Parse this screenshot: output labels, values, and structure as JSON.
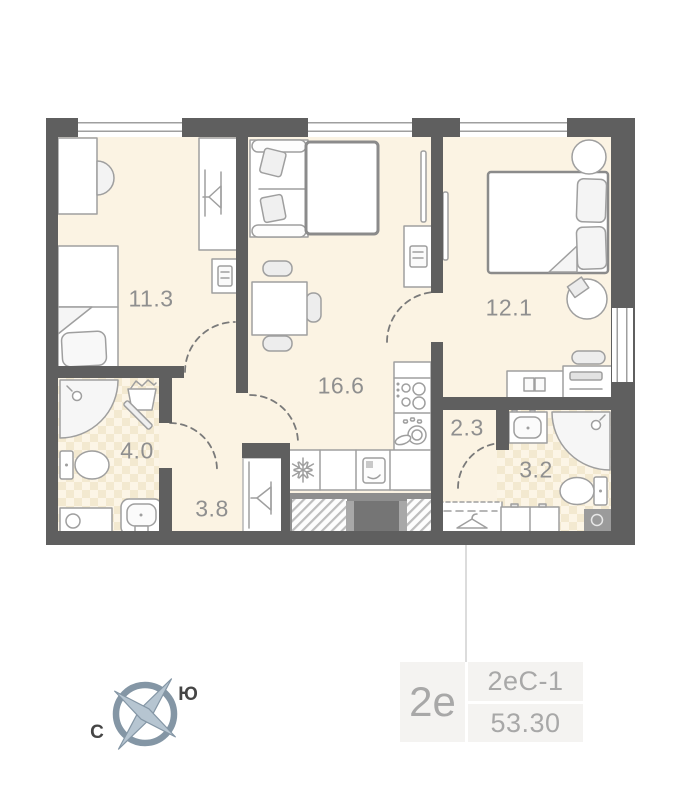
{
  "plan": {
    "rooms": [
      {
        "name": "bedroom-1",
        "area": "11.3"
      },
      {
        "name": "living-kitchen",
        "area": "16.6"
      },
      {
        "name": "bedroom-2",
        "area": "12.1"
      },
      {
        "name": "bathroom-1",
        "area": "4.0"
      },
      {
        "name": "hallway",
        "area": "3.8"
      },
      {
        "name": "corridor",
        "area": "2.3"
      },
      {
        "name": "bathroom-2",
        "area": "3.2"
      }
    ]
  },
  "info_card": {
    "apartment_type": "2е",
    "layout_code": "2еС-1",
    "total_area": "53.30"
  },
  "compass": {
    "south_label": "Ю",
    "north_label": "С"
  },
  "colors": {
    "wall": "#5f5f5f",
    "floor": "#fbf3e3",
    "tile_accent": "#f3e9d0",
    "furniture_line": "#9f9f9f",
    "room_label_text": "#8f8f8f",
    "info_text": "#a8a8a8",
    "compass": "#8496a5"
  }
}
